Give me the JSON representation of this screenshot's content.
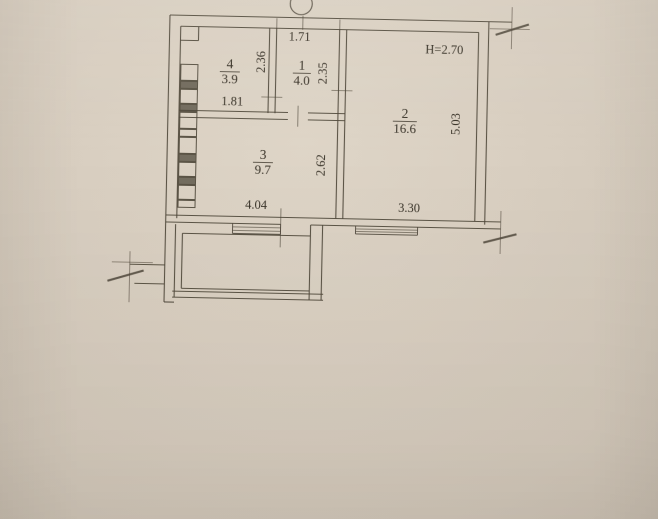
{
  "document": {
    "kind": "apartment-floor-plan-photo",
    "paper_color": "#d9cfc1",
    "line_color": "#4e4639",
    "text_color": "#3a342a",
    "rotation_deg": 1.2
  },
  "plan": {
    "height_note": "H=2.70",
    "rooms": [
      {
        "number": "1",
        "area": "4.0",
        "x": 303,
        "y": 67,
        "ul": 9
      },
      {
        "number": "2",
        "area": "16.6",
        "x": 407,
        "y": 113,
        "ul": 12
      },
      {
        "number": "3",
        "area": "9.7",
        "x": 266,
        "y": 157,
        "ul": 10
      },
      {
        "number": "4",
        "area": "3.9",
        "x": 231,
        "y": 67,
        "ul": 10
      }
    ],
    "dimensions": [
      {
        "value": "1.71",
        "x": 300,
        "y": 38,
        "rotate": 0
      },
      {
        "value": "2.36",
        "x": 266,
        "y": 60,
        "rotate": -90
      },
      {
        "value": "2.35",
        "x": 328,
        "y": 70,
        "rotate": -90
      },
      {
        "value": "1.81",
        "x": 234,
        "y": 104,
        "rotate": 0
      },
      {
        "value": "2.62",
        "x": 328,
        "y": 162,
        "rotate": -90
      },
      {
        "value": "5.03",
        "x": 462,
        "y": 118,
        "rotate": -90
      },
      {
        "value": "4.04",
        "x": 260,
        "y": 207,
        "rotate": 0
      },
      {
        "value": "3.30",
        "x": 413,
        "y": 207,
        "rotate": 0
      },
      {
        "value": "H=2.70",
        "x": 445,
        "y": 48,
        "rotate": 0
      }
    ],
    "walls": [
      [
        170,
        15,
        512,
        15
      ],
      [
        181,
        26,
        479,
        26
      ],
      [
        170,
        15,
        170,
        302
      ],
      [
        181,
        26,
        181,
        218
      ],
      [
        489,
        15,
        489,
        218
      ],
      [
        479,
        26,
        479,
        215
      ],
      [
        170,
        215,
        505,
        215
      ],
      [
        170,
        222,
        285,
        222
      ],
      [
        315,
        222,
        505,
        222
      ],
      [
        270,
        26,
        270,
        111
      ],
      [
        277,
        26,
        277,
        111
      ],
      [
        340,
        26,
        340,
        215
      ],
      [
        347,
        26,
        347,
        215
      ],
      [
        181,
        110,
        290,
        110
      ],
      [
        310,
        110,
        347,
        110
      ],
      [
        181,
        117,
        290,
        117
      ],
      [
        310,
        117,
        347,
        117
      ],
      [
        199,
        26,
        199,
        40
      ],
      [
        181,
        40,
        199,
        40
      ],
      [
        180,
        224,
        180,
        297
      ],
      [
        187,
        233,
        187,
        288
      ],
      [
        315,
        222,
        315,
        297
      ],
      [
        327,
        222,
        327,
        297
      ],
      [
        187,
        233,
        315,
        233
      ],
      [
        187,
        288,
        315,
        288
      ],
      [
        178,
        291,
        329,
        291
      ],
      [
        178,
        297,
        329,
        297
      ],
      [
        135,
        265,
        170,
        265
      ],
      [
        140,
        284,
        170,
        284
      ],
      [
        170,
        302,
        180,
        302
      ]
    ],
    "thin_lines": [
      [
        135,
        252,
        135,
        303
      ],
      [
        117,
        263,
        158,
        263
      ],
      [
        512,
        0,
        512,
        42
      ],
      [
        490,
        22,
        530,
        22
      ],
      [
        505,
        204,
        505,
        247
      ]
    ],
    "opening_ticks": [
      [
        263,
        95,
        284,
        95
      ],
      [
        333,
        87,
        354,
        87
      ],
      [
        300,
        103,
        300,
        124
      ],
      [
        285,
        206,
        285,
        245
      ],
      [
        277,
        16,
        277,
        27
      ],
      [
        340,
        16,
        340,
        27
      ],
      [
        303,
        13,
        303,
        27
      ]
    ],
    "slashes": [
      [
        496,
        28,
        529,
        17
      ],
      [
        488,
        236,
        521,
        227
      ],
      [
        113,
        282,
        149,
        271
      ]
    ],
    "windows": [
      {
        "x1": 237,
        "x2": 285,
        "y_top": 222,
        "y_bot": 232,
        "mids": [
          225.5,
          229
        ]
      },
      {
        "x1": 360,
        "x2": 422,
        "y_top": 222,
        "y_bot": 230,
        "mids": [
          225,
          227.5
        ]
      }
    ],
    "vent_shaft": {
      "x": 182,
      "w": 17,
      "boxes": [
        {
          "y": 64,
          "h": 16,
          "f": 0
        },
        {
          "y": 81,
          "h": 7,
          "f": 1
        },
        {
          "y": 89,
          "h": 14,
          "f": 0
        },
        {
          "y": 104,
          "h": 7,
          "f": 1
        },
        {
          "y": 112,
          "h": 16,
          "f": 0
        },
        {
          "y": 129,
          "h": 7,
          "f": 0
        },
        {
          "y": 137,
          "h": 16,
          "f": 0
        },
        {
          "y": 154,
          "h": 7,
          "f": 1
        },
        {
          "y": 162,
          "h": 14,
          "f": 0
        },
        {
          "y": 177,
          "h": 7,
          "f": 1
        },
        {
          "y": 185,
          "h": 14,
          "f": 0
        },
        {
          "y": 200,
          "h": 7,
          "f": 0
        }
      ]
    },
    "axis_marker": {
      "cx": 301,
      "cy": 1,
      "r": 11
    }
  }
}
